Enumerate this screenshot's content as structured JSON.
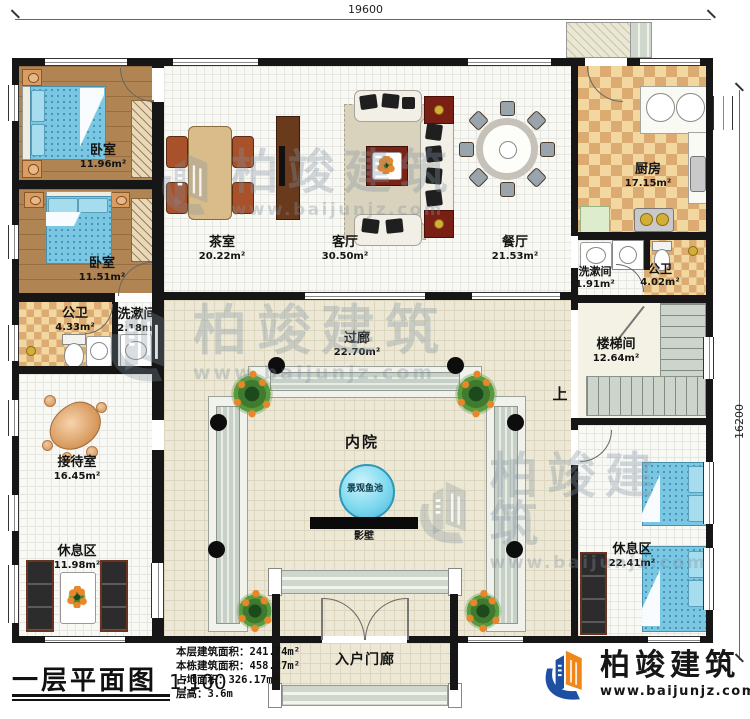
{
  "dimensions": {
    "top": "19600",
    "right": "16200"
  },
  "rooms": [
    {
      "name": "卧室",
      "area": "11.96m²"
    },
    {
      "name": "卧室",
      "area": "11.51m²"
    },
    {
      "name": "公卫",
      "area": "4.33m²"
    },
    {
      "name": "洗漱间",
      "area": "2.18m²"
    },
    {
      "name": "接待室",
      "area": "16.45m²"
    },
    {
      "name": "休息区",
      "area": "11.98m²"
    },
    {
      "name": "茶室",
      "area": "20.22m²"
    },
    {
      "name": "客厅",
      "area": "30.50m²"
    },
    {
      "name": "餐厅",
      "area": "21.53m²"
    },
    {
      "name": "厨房",
      "area": "17.15m²"
    },
    {
      "name": "洗漱间",
      "area": "1.91m²"
    },
    {
      "name": "公卫",
      "area": "4.02m²"
    },
    {
      "name": "楼梯间",
      "area": "12.64m²"
    },
    {
      "name": "过廊",
      "area": "22.70m²"
    },
    {
      "name": "内院",
      "area": ""
    },
    {
      "name": "景观鱼池",
      "area": ""
    },
    {
      "name": "影壁",
      "area": ""
    },
    {
      "name": "休息区",
      "area": "22.41m²"
    },
    {
      "name": "入户门廊",
      "area": ""
    }
  ],
  "stair_up_label": "上",
  "footer": {
    "title": "一层平面图",
    "scale": "1:100",
    "stats": [
      {
        "label": "本层建筑面积：",
        "value": "241.74m²"
      },
      {
        "label": "本栋建筑面积：",
        "value": "458.27m²"
      },
      {
        "label": "占地面积：",
        "value": "326.17m²"
      },
      {
        "label": "层高：",
        "value": "3.6m"
      }
    ]
  },
  "logo": {
    "name": "柏竣建筑",
    "url": "www.baijunjz.com"
  },
  "watermark": {
    "name": "柏竣建筑",
    "url": "www.baijunjz.com"
  },
  "colors": {
    "logo_blue": "#1d50a3",
    "logo_orange": "#f08519",
    "pond": "#7fd9ef",
    "wall": "#161616"
  }
}
